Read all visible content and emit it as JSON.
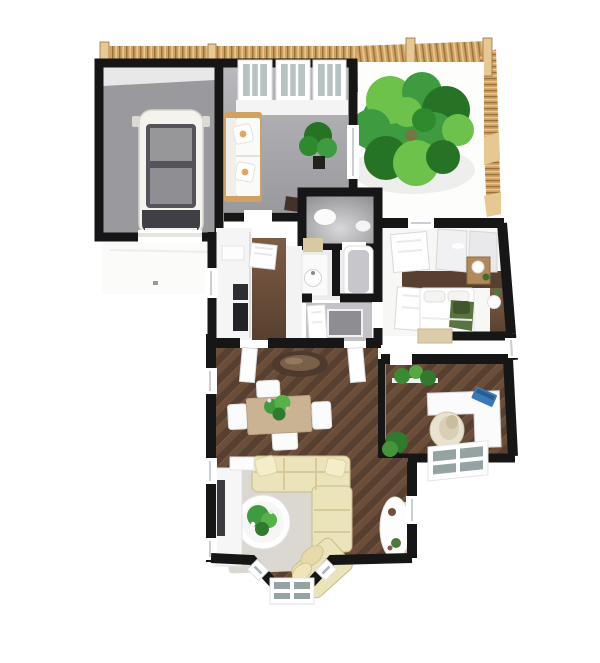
{
  "scene": {
    "kind": "3d-floor-plan-render",
    "view": "top-down dollhouse perspective",
    "background": "#ffffff"
  },
  "palette": {
    "wall": "#161616",
    "floor_gray": "#9a9a9e",
    "floor_gray_dark": "#86868a",
    "floor_light": "#ededef",
    "wood_dark": "#57402f",
    "wood_mid": "#6b4e3a",
    "wood_light": "#7d5c46",
    "fence": "#cfa264",
    "fence_light": "#e6c893",
    "fence_dark": "#99713d",
    "tree_dark": "#267326",
    "tree_mid": "#3f9b3f",
    "tree_light": "#6cc24a",
    "sofa_cream": "#ebe3ba",
    "sofa_cream_dark": "#d9cc9c",
    "sofa_outline": "#c6bb8d",
    "table_tan": "#c9b392",
    "rug": "#dbd7d1",
    "white": "#ffffff",
    "off_white": "#f6f6f4",
    "panel_gray": "#e3e3e5",
    "glass": "#95a3a3",
    "glass_light": "#b9c2c2",
    "car_body": "#f5f3ee",
    "car_dark": "#3f3f45",
    "car_glass": "#97979a",
    "laptop_blue": "#3879b8",
    "bed_green": "#5a7440",
    "bed_green_dark": "#41562c",
    "pillow_accent": "#e2a75c",
    "tub_gray": "#c7c7cb",
    "appliance": "#2e2e32",
    "nightstand_wood": "#b08a5a",
    "oval_table": "#4e3a2c",
    "oval_table_inner": "#7a5f49",
    "shadow": "#000000"
  },
  "rooms": [
    {
      "id": "garage",
      "contents": [
        "car",
        "driveway"
      ]
    },
    {
      "id": "sitting-room",
      "contents": [
        "sofa",
        "three-windows",
        "potted-plant"
      ]
    },
    {
      "id": "patio",
      "contents": [
        "tree",
        "wood-fence"
      ]
    },
    {
      "id": "wc",
      "contents": [
        "toilet",
        "basin"
      ]
    },
    {
      "id": "kitchen",
      "contents": [
        "cabinets",
        "appliances"
      ]
    },
    {
      "id": "bathroom",
      "contents": [
        "sink",
        "bathtub",
        "shower"
      ]
    },
    {
      "id": "bedroom",
      "contents": [
        "bed",
        "wardrobe",
        "nightstand",
        "lamp"
      ]
    },
    {
      "id": "office",
      "contents": [
        "corner-desk",
        "laptop",
        "egg-chair",
        "plants",
        "box-window"
      ]
    },
    {
      "id": "dining-area",
      "contents": [
        "dining-table",
        "four-chairs",
        "centerpiece",
        "oval-console"
      ]
    },
    {
      "id": "living-area",
      "contents": [
        "sectional-sofa",
        "round-coffee-table",
        "rug",
        "tv-console",
        "flower-table",
        "bay-window"
      ]
    }
  ]
}
